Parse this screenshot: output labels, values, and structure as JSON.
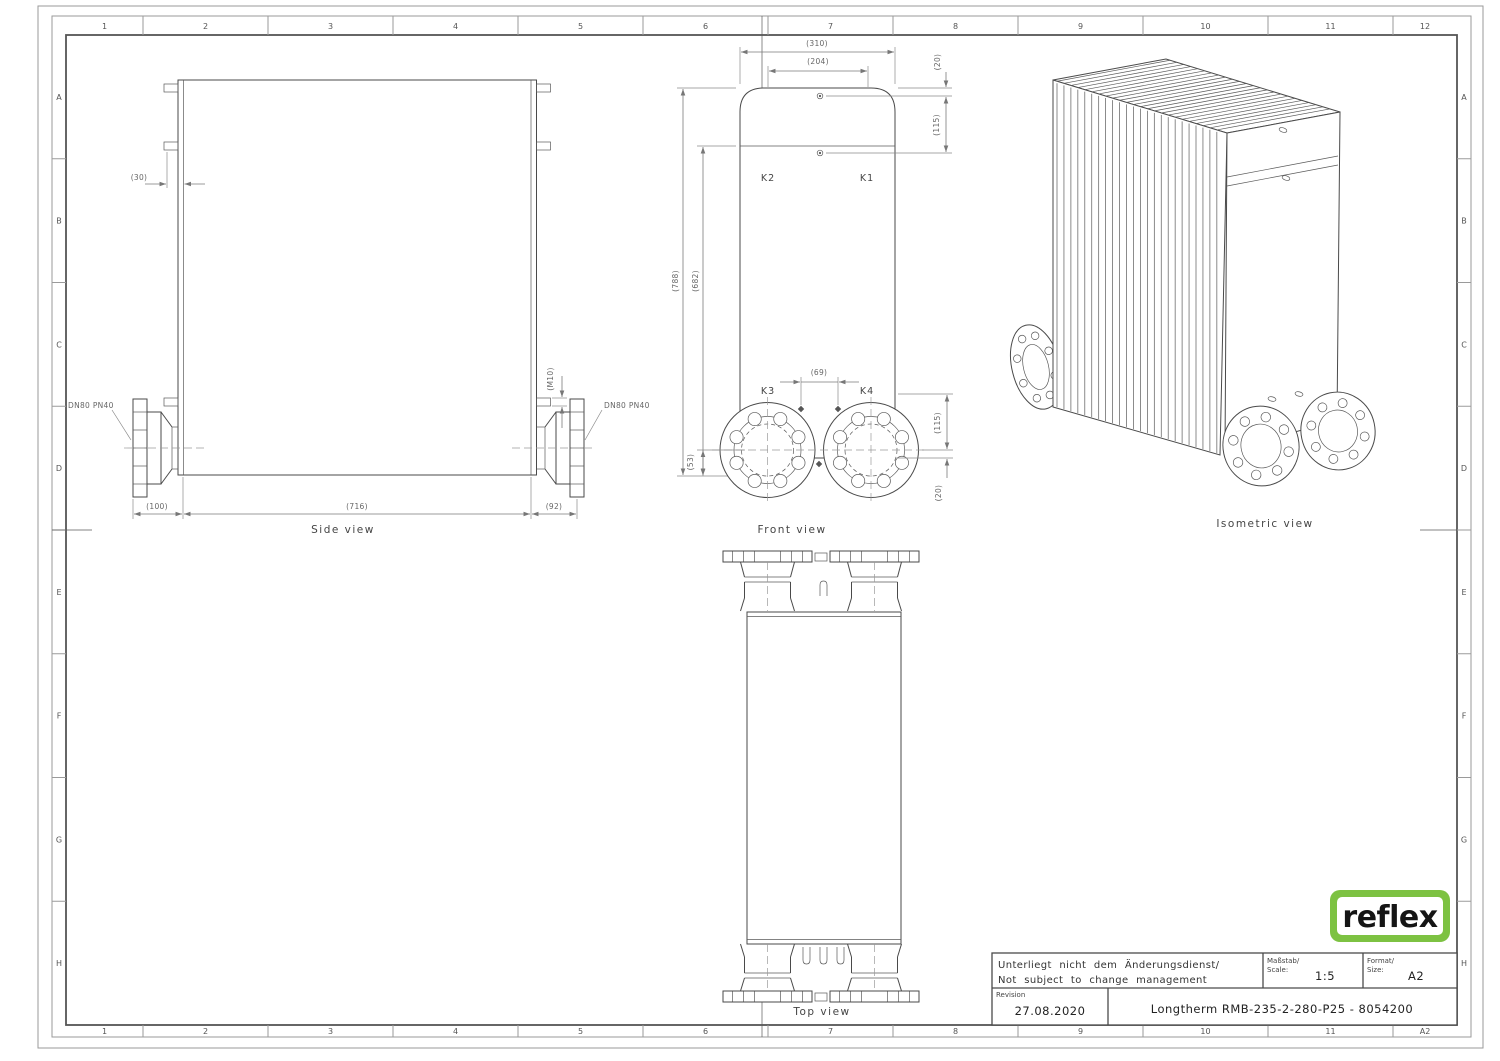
{
  "colors": {
    "line": "#4a4a4a",
    "dimension": "#7a7a7a",
    "logo_green": "#7dc242",
    "logo_text": "#151515"
  },
  "grid": {
    "cols": [
      "1",
      "2",
      "3",
      "4",
      "5",
      "6",
      "7",
      "8",
      "9",
      "10",
      "11",
      "12"
    ],
    "cols_bottom": [
      "1",
      "2",
      "3",
      "4",
      "5",
      "6",
      "7",
      "8",
      "9",
      "10",
      "11",
      "A2"
    ],
    "rows": [
      "A",
      "B",
      "C",
      "D",
      "E",
      "F",
      "G",
      "H"
    ]
  },
  "side_view": {
    "label": "Side view",
    "dim_30": "(30)",
    "dim_m10": "(M10)",
    "dim_100": "(100)",
    "dim_716": "(716)",
    "dim_92": "(92)",
    "flange_left": "DN80 PN40",
    "flange_right": "DN80 PN40"
  },
  "front_view": {
    "label": "Front view",
    "dim_310": "(310)",
    "dim_204": "(204)",
    "dim_20_top": "(20)",
    "dim_115_top": "(115)",
    "dim_788": "(788)",
    "dim_682": "(682)",
    "dim_69": "(69)",
    "dim_115_bottom": "(115)",
    "dim_20_bottom": "(20)",
    "dim_53": "(53)",
    "port_k1": "K1",
    "port_k2": "K2",
    "port_k3": "K3",
    "port_k4": "K4"
  },
  "top_view": {
    "label": "Top view"
  },
  "isometric_view": {
    "label": "Isometric view"
  },
  "title_block": {
    "note_line1": "Unterliegt nicht dem Änderungsdienst/",
    "note_line2": "Not subject to change management",
    "scale_label_de": "Maßstab/",
    "scale_label_en": "Scale:",
    "scale_value": "1:5",
    "format_label_de": "Format/",
    "format_label_en": "Size:",
    "format_value": "A2",
    "revision_label": "Revision",
    "revision_date": "27.08.2020",
    "drawing_title": "Longtherm RMB-235-2-280-P25 - 8054200"
  },
  "logo": {
    "text": "reflex"
  }
}
